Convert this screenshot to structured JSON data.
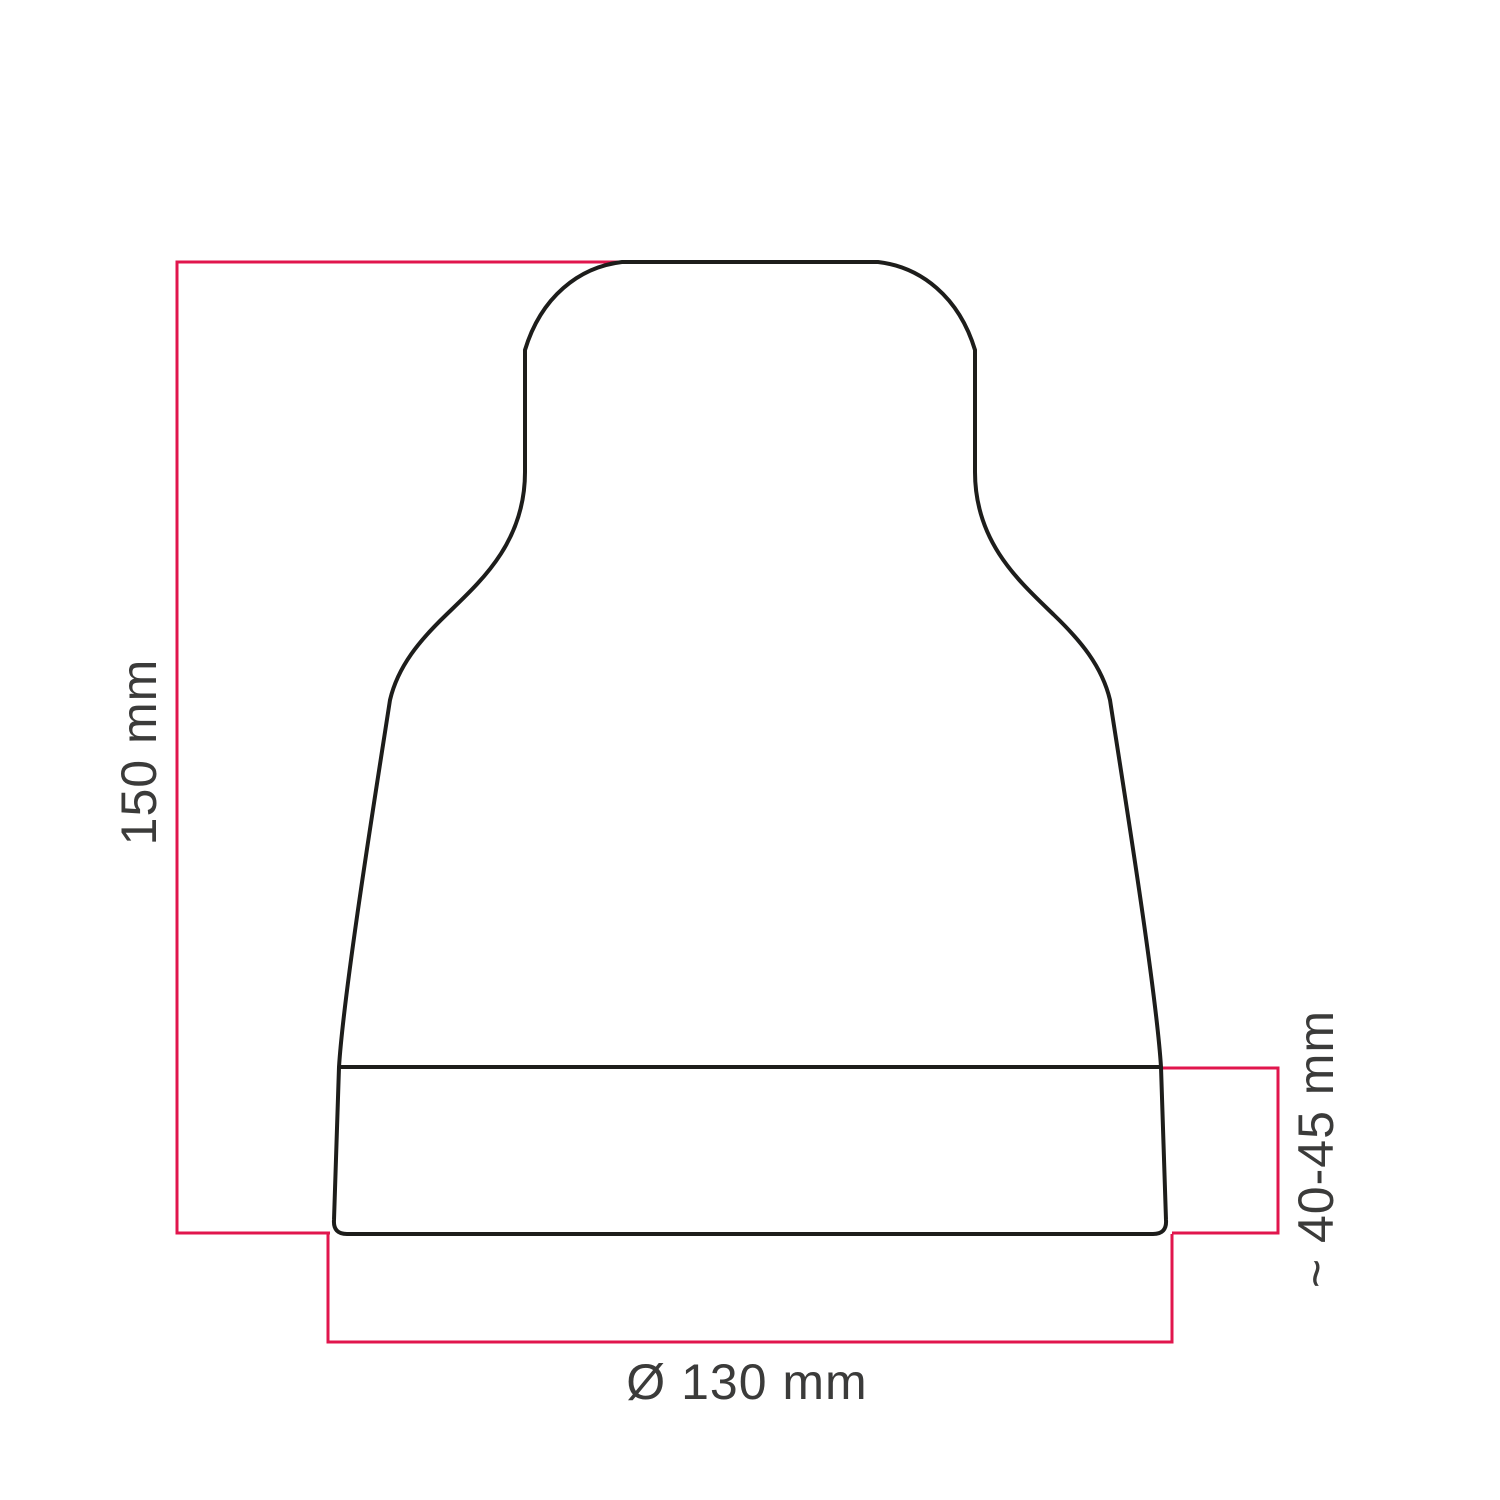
{
  "diagram": {
    "labels": {
      "height": "150 mm",
      "band": "~ 40-45 mm",
      "diameter": "Ø 130 mm"
    },
    "colors": {
      "dimension": "#e1164d",
      "outline": "#1d1d1b",
      "text": "#3b3b3a",
      "background": "#ffffff"
    }
  }
}
